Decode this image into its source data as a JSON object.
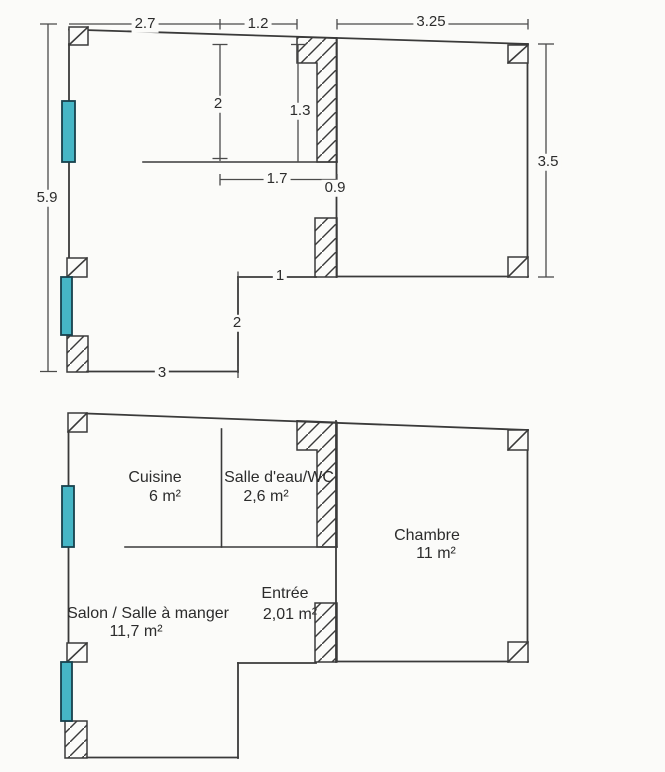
{
  "page": {
    "title": "floor-plan",
    "background": "#fbfbf9",
    "line_color": "#3a3a3a",
    "window_color": "#46b6c6"
  },
  "upper_plan": {
    "dims": {
      "top_left_width": "2.7",
      "top_mid_width": "1.2",
      "top_right_width": "3.25",
      "left_height": "5.9",
      "right_height": "3.5",
      "kitchen_depth": "2",
      "bath_door_height": "1.3",
      "kitchen_width": "1.7",
      "bedroom_door": "0.9",
      "entry_notch_width": "1",
      "salon_notch_height": "2",
      "bottom_width": "3"
    }
  },
  "lower_plan": {
    "rooms": {
      "cuisine": {
        "name": "Cuisine",
        "area": "6  m²"
      },
      "salle_eau": {
        "name": "Salle d'eau/WC",
        "area": "2,6  m²"
      },
      "chambre": {
        "name": "Chambre",
        "area": "11  m²"
      },
      "salon": {
        "name": "Salon / Salle à manger",
        "area": "11,7  m²"
      },
      "entree": {
        "name": "Entrée",
        "area": "2,01  m²"
      }
    }
  }
}
